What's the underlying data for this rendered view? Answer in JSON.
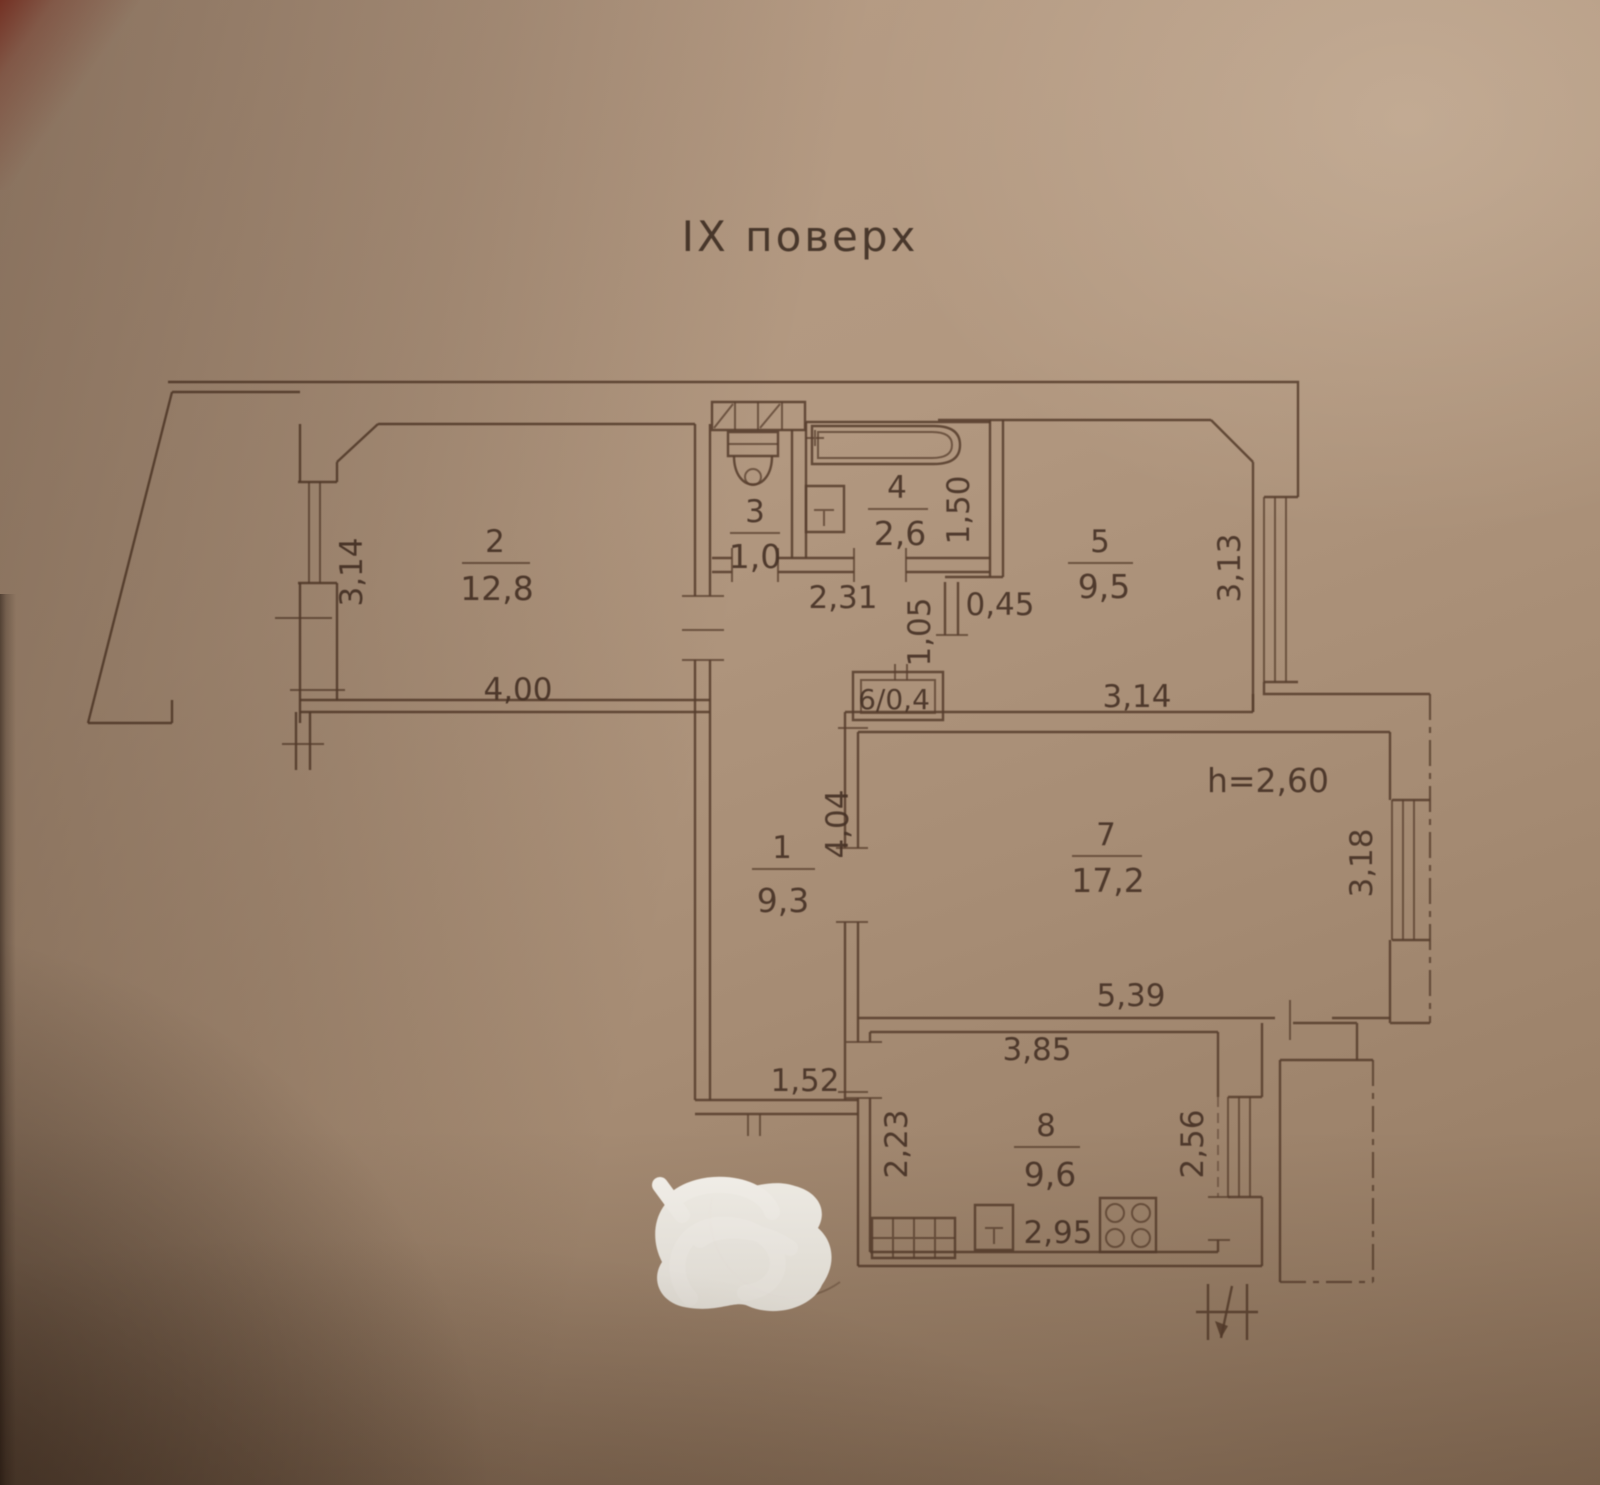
{
  "title": "IX поверх",
  "plan": {
    "height_note": "h=2,60",
    "rooms": [
      {
        "number": "1",
        "area": "9,3"
      },
      {
        "number": "2",
        "area": "12,8"
      },
      {
        "number": "3",
        "area": "1,0"
      },
      {
        "number": "4",
        "area": "2,6"
      },
      {
        "number": "5",
        "area": "9,5"
      },
      {
        "number": "6",
        "label": "6/0,4"
      },
      {
        "number": "7",
        "area": "17,2"
      },
      {
        "number": "8",
        "area": "9,6"
      }
    ],
    "dims": {
      "room2_side": "3,14",
      "room2_bottom": "4,00",
      "hall_top": "2,31",
      "hall_side": "1,05",
      "hall_stub": "0,45",
      "bath_side": "1,50",
      "room5_side": "3,13",
      "room5_bottom": "3,14",
      "corridor_side": "4,04",
      "corridor_bottom": "1,52",
      "room7_side": "3,18",
      "room7_bottom": "5,39",
      "kitchen_top": "3,85",
      "kitchen_left": "2,23",
      "kitchen_right": "2,56",
      "kitchen_bottom": "2,95"
    }
  }
}
